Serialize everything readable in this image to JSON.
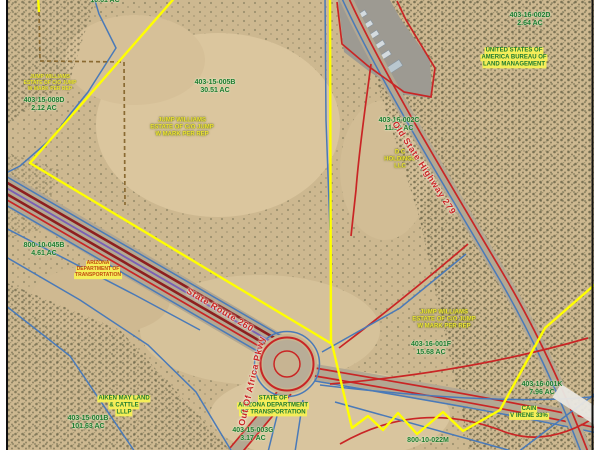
{
  "map": {
    "colors": {
      "parcel_boundary_yellow": "#ffff00",
      "road_red": "#c92525",
      "dark_red": "#8e1f1f",
      "row_blue": "#4a7ab8",
      "utility_purple": "#7a5fb5",
      "apn_green": "#1d7a2e",
      "owner_yellow": "#f0e636",
      "highlight_yellow": "#f5ee58"
    },
    "region_labels": [
      {
        "id": "apn-top-clipped",
        "style": "apn",
        "x": 105,
        "y": 1,
        "lines": [
          "10.61 AC"
        ]
      },
      {
        "id": "owner-008d",
        "style": "owner-yellow-sm",
        "x": 50,
        "y": 84,
        "lines": [
          "JUMP WILLIAMS",
          "ESTATE OF C/O JUMP",
          "W MARK PER REP"
        ]
      },
      {
        "id": "apn-008d",
        "style": "apn",
        "x": 44,
        "y": 105,
        "lines": [
          "403-15-008D",
          "2.12 AC"
        ]
      },
      {
        "id": "apn-005b",
        "style": "apn",
        "x": 215,
        "y": 87,
        "lines": [
          "403-15-005B",
          "30.51 AC"
        ]
      },
      {
        "id": "owner-005b",
        "style": "owner-yellow",
        "x": 182,
        "y": 128,
        "lines": [
          "JUMP WILLIAMS",
          "ESTATE OF C/O JUMP",
          "W MARK PER REP"
        ]
      },
      {
        "id": "apn-002d",
        "style": "apn",
        "x": 530,
        "y": 20,
        "lines": [
          "403-16-002D",
          "2.64 AC"
        ]
      },
      {
        "id": "owner-002d-blm",
        "style": "owner-hl",
        "x": 514,
        "y": 58,
        "lines": [
          "UNITED STATES OF",
          "AMERICA BUREAU OF",
          "LAND MANAGEMENT"
        ]
      },
      {
        "id": "apn-002c",
        "style": "apn",
        "x": 399,
        "y": 125,
        "lines": [
          "403-16-002C",
          "11.18 AC"
        ]
      },
      {
        "id": "owner-002c",
        "style": "owner-yellow",
        "x": 400,
        "y": 160,
        "lines": [
          "D C",
          "HOLDINGS",
          "LLC"
        ]
      },
      {
        "id": "owner-001f",
        "style": "owner-yellow",
        "x": 444,
        "y": 320,
        "lines": [
          "JUMP WILLIAMS",
          "ESTATE OF C/O JUMP",
          "W MARK PER REP"
        ]
      },
      {
        "id": "apn-001f",
        "style": "apn",
        "x": 431,
        "y": 349,
        "lines": [
          "403-16-001F",
          "15.68 AC"
        ]
      },
      {
        "id": "apn-001k",
        "style": "apn",
        "x": 542,
        "y": 389,
        "lines": [
          "403-16-001K",
          "7.96 AC"
        ]
      },
      {
        "id": "owner-001k",
        "style": "owner-hl",
        "x": 529,
        "y": 413,
        "lines": [
          "CAIN",
          "V IRENE 33%"
        ]
      },
      {
        "id": "apn-045b",
        "style": "apn",
        "x": 44,
        "y": 250,
        "lines": [
          "800-10-045B",
          "4.61 AC"
        ]
      },
      {
        "id": "owner-045b-adot",
        "style": "adot",
        "x": 98,
        "y": 270,
        "lines": [
          "ARIZONA",
          "DEPARTMENT OF",
          "TRANSPORTATION"
        ]
      },
      {
        "id": "owner-001b",
        "style": "owner-hl",
        "x": 124,
        "y": 406,
        "lines": [
          "AIKEN MAY LAND",
          "& CATTLE",
          "LLLP"
        ]
      },
      {
        "id": "apn-001b",
        "style": "apn",
        "x": 88,
        "y": 423,
        "lines": [
          "403-15-001B",
          "101.63 AC"
        ]
      },
      {
        "id": "owner-adot-roundabout",
        "style": "owner-hl",
        "x": 273,
        "y": 406,
        "lines": [
          "STATE OF",
          "ARIZONA DEPARTMENT",
          "OF TRANSPORTATION"
        ]
      },
      {
        "id": "apn-003g",
        "style": "apn",
        "x": 253,
        "y": 435,
        "lines": [
          "403-15-003G",
          "3.17 AC"
        ]
      },
      {
        "id": "apn-022m",
        "style": "apn",
        "x": 428,
        "y": 441,
        "lines": [
          "800-10-022M"
        ]
      }
    ],
    "road_labels": [
      {
        "id": "road-old-state-highway-279",
        "text": "Old State Highway 279",
        "x": 424,
        "y": 168,
        "rot": 57
      },
      {
        "id": "road-state-route-260",
        "text": "State Route 260",
        "x": 220,
        "y": 310,
        "rot": 31
      },
      {
        "id": "road-out-of-africa-pkwy",
        "text": "Out Of Africa Pkwy",
        "x": 252,
        "y": 381,
        "rot": -77
      }
    ]
  }
}
